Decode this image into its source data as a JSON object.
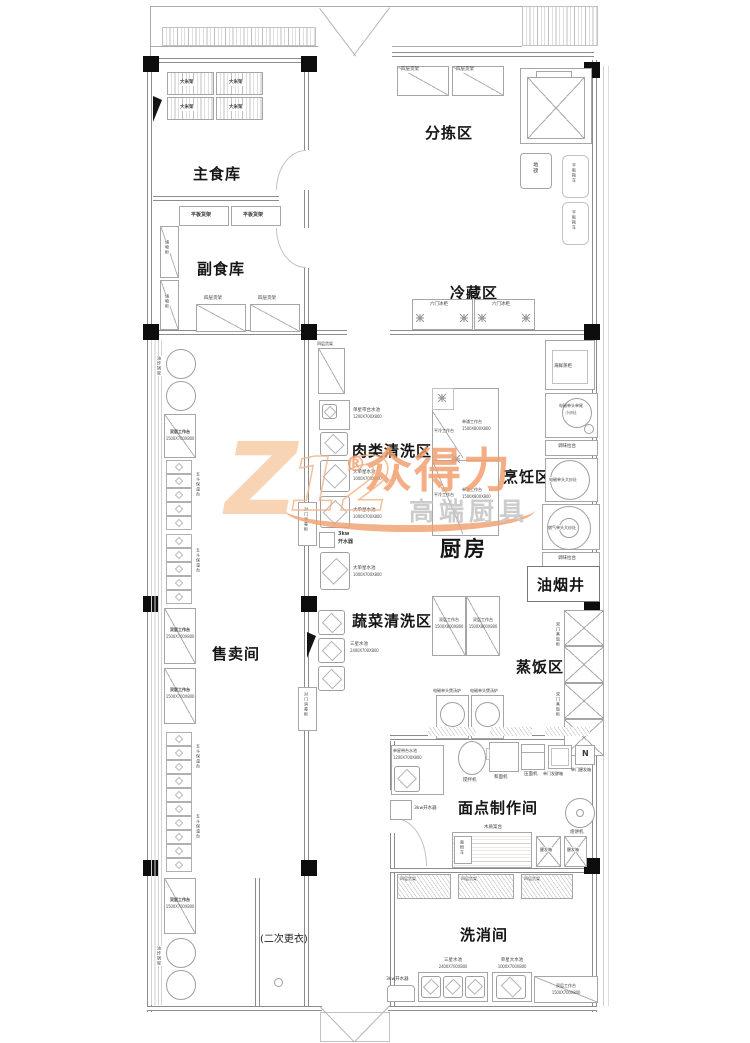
{
  "watermark": {
    "logo_letter": "Z",
    "logo_numbers": "12",
    "registered_mark": "®",
    "brand_text": "众得力",
    "tagline_text": "高端厨具",
    "accent_color": "#ef9f6d",
    "light_color": "#f7cba6",
    "tagline_color": "#c2c2c2"
  },
  "rooms": {
    "main_food_storage": "主食库",
    "side_food_storage": "副食库",
    "sorting_area": "分拣区",
    "cold_storage_area": "冷藏区",
    "meat_washing_area": "肉类清洗区",
    "cooking_area": "烹饪区",
    "kitchen": "厨房",
    "smoke_shaft": "油烟井",
    "vegetable_washing_area": "蔬菜清洗区",
    "rice_steaming_area": "蒸饭区",
    "sales_room": "售卖间",
    "pastry_room": "面点制作间",
    "washing_room": "洗消间",
    "second_changing": "(二次更衣)"
  },
  "equipment": {
    "rice_rack": "大米架",
    "flat_shelf": "平板货架",
    "four_layer_shelf": "四层货架",
    "storage_cabinet": "储物柜",
    "floor_scale": "地磅",
    "flat_trolley": "平板拖车",
    "six_door_fridge": "六门冰柜",
    "fryer_rack": "油炸锅架",
    "double_worktable": "双层工作台",
    "double_worktable_dims": "1500X700X800",
    "bain_marie": "五斗保温台",
    "pass_disinfect_cabinet": "对门消毒柜",
    "sink_with_counter": "单星带台水池",
    "sink_with_counter_dims": "1200X700X800",
    "big_single_sink": "大单星水池",
    "big_single_sink_dims": "1000X700X800",
    "boiler_kw": "3kw",
    "boiler": "开水器",
    "boiler_inline": "3kw开水器",
    "cold_worktable": "平冷工作台",
    "single_pass_worktable": "单通工作台",
    "single_pass_worktable_dims": "1500X800X800",
    "seafood_steamer": "海鲜蒸柜",
    "small_wok_line1": "电磁单头单尾",
    "small_wok_line2": "小炒灶",
    "spice_counter": "调味拉台",
    "induction_big_wok": "电磁单头大炒灶",
    "gas_big_wok": "燃气单头大炒灶",
    "double_worktable2": "双层工作台",
    "double_worktable2_dims": "1500X800X800",
    "soup_stove": "电磁单头煲汤炉",
    "rice_steam_cabinet": "双门蒸饭柜",
    "triple_sink": "三星水池",
    "triple_sink_dims": "2400X700X800",
    "mixer": "搅拌机",
    "dough_mixer": "和面机",
    "dough_press": "压面机",
    "ferment_box": "单门发酵箱",
    "proof_box_single": "单门醒发箱",
    "pancake_machine": "烙饼机",
    "wood_table": "木质案台",
    "flour_cart": "面粉车",
    "proof_box": "醒发箱",
    "big_single_sink2": "单星大水池",
    "big_single_sink2_dims": "1000X700X800",
    "compass_letter": "N"
  }
}
